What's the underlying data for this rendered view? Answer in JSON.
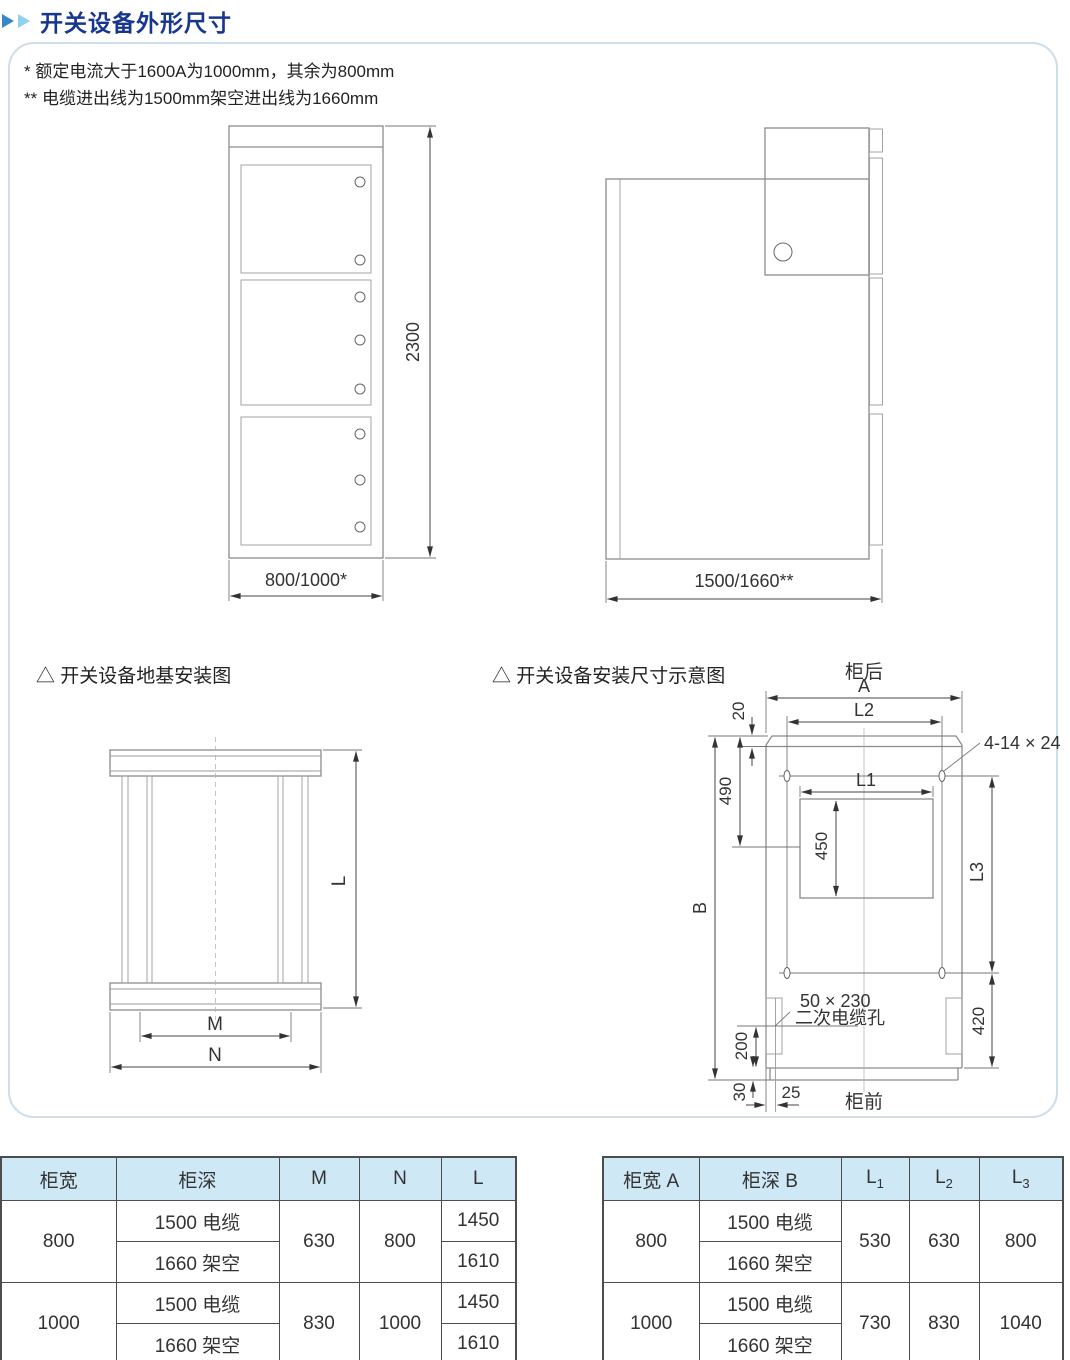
{
  "header": {
    "title": "开关设备外形尺寸"
  },
  "colors": {
    "title_blue": "#17368e",
    "arrow_blue": "#3a87c8",
    "arrow_light_blue": "#92cff0",
    "table_header_bg": "#cfe8f6",
    "panel_border": "#ccdeea"
  },
  "panel": {
    "notes": [
      "* 额定电流大于1600A为1000mm，其余为800mm",
      "** 电缆进出线为1500mm架空进出线为1660mm"
    ],
    "captions": {
      "foundation": "△ 开关设备地基安装图",
      "installation": "△ 开关设备安装尺寸示意图"
    }
  },
  "drawings": {
    "front_view": {
      "height_dim": "2300",
      "width_dim": "800/1000*"
    },
    "side_view": {
      "depth_dim": "1500/1660**"
    },
    "foundation": {
      "dim_l": "L",
      "dim_m": "M",
      "dim_n": "N"
    },
    "installation": {
      "rear_label": "柜后",
      "front_label": "柜前",
      "dim_a": "A",
      "dim_b": "B",
      "dim_l1": "L1",
      "dim_l2": "L2",
      "dim_l3": "L3",
      "dim_20": "20",
      "dim_490": "490",
      "dim_450": "450",
      "dim_420": "420",
      "dim_200": "200",
      "dim_30": "30",
      "dim_25": "25",
      "hole_spec": "4-14 × 24",
      "cable_hole_size": "50 × 230",
      "cable_hole_label": "二次电缆孔"
    }
  },
  "tables": {
    "left": {
      "headers": [
        "柜宽",
        "柜深",
        "M",
        "N",
        "L"
      ],
      "groups": [
        {
          "width": "800",
          "rows": [
            {
              "depth": "1500 电缆",
              "l": "1450"
            },
            {
              "depth": "1660 架空",
              "l": "1610"
            }
          ],
          "m": "630",
          "n": "800"
        },
        {
          "width": "1000",
          "rows": [
            {
              "depth": "1500 电缆",
              "l": "1450"
            },
            {
              "depth": "1660 架空",
              "l": "1610"
            }
          ],
          "m": "830",
          "n": "1000"
        }
      ]
    },
    "right": {
      "headers": [
        "柜宽 A",
        "柜深 B"
      ],
      "lcols": [
        {
          "base": "L",
          "sub": "1"
        },
        {
          "base": "L",
          "sub": "2"
        },
        {
          "base": "L",
          "sub": "3"
        }
      ],
      "groups": [
        {
          "width": "800",
          "rows": [
            {
              "depth": "1500 电缆"
            },
            {
              "depth": "1660 架空"
            }
          ],
          "l1": "530",
          "l2": "630",
          "l3": "800"
        },
        {
          "width": "1000",
          "rows": [
            {
              "depth": "1500 电缆"
            },
            {
              "depth": "1660 架空"
            }
          ],
          "l1": "730",
          "l2": "830",
          "l3": "1040"
        }
      ]
    }
  }
}
